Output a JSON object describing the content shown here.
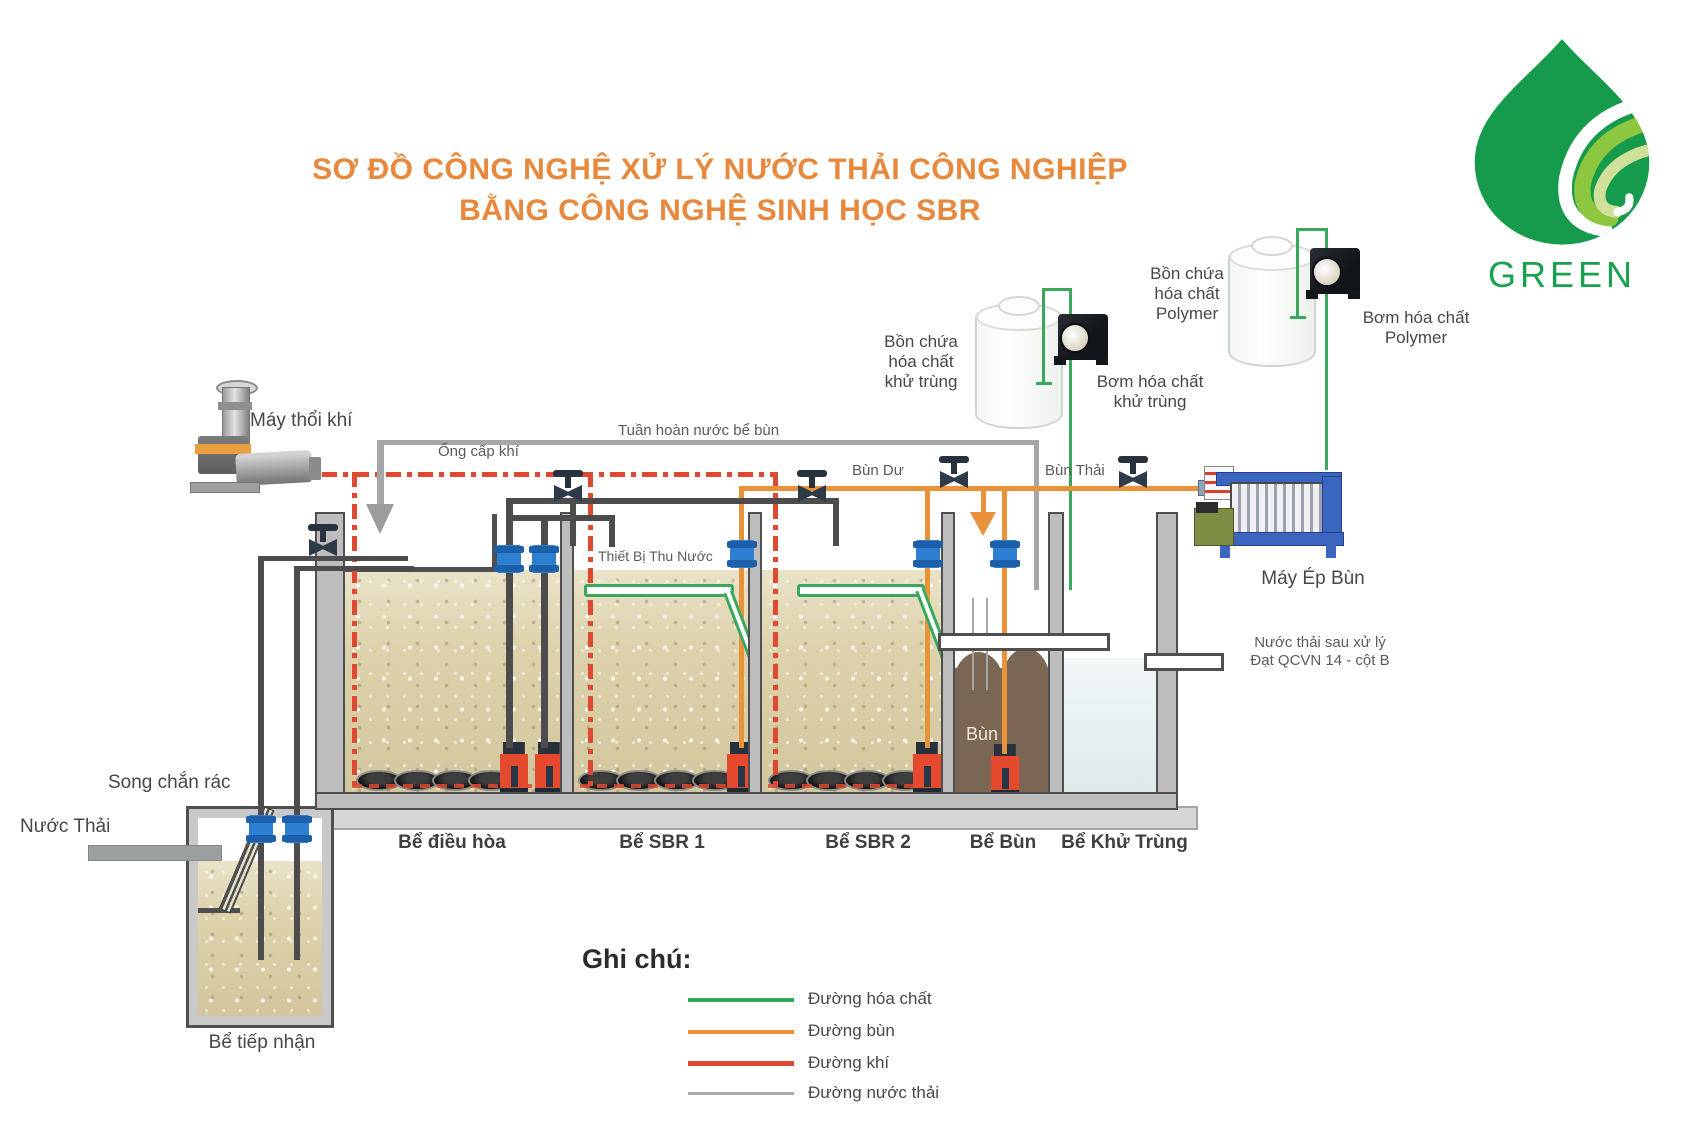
{
  "title": {
    "line1": "SƠ ĐỒ CÔNG NGHỆ XỬ LÝ NƯỚC THẢI CÔNG NGHIỆP",
    "line2": "BẰNG CÔNG NGHỆ SINH HỌC SBR"
  },
  "logo": {
    "text": "GREEN"
  },
  "colors": {
    "accent": "#e8883c",
    "chemical": "#3aa85c",
    "sludge": "#e8923a",
    "air": "#dd4a31",
    "waterline": "#a6a6a6"
  },
  "labels": {
    "blower": "Máy thổi khí",
    "air_supply": "Ống cấp khí",
    "recirculation": "Tuần hoàn nước bể bùn",
    "excess_sludge": "Bùn Dư",
    "waste_sludge": "Bùn Thải",
    "decanter": "Thiết Bị Thu Nước",
    "sludge": "Bùn",
    "chem_tank_disinfect": "Bồn chứa\nhóa chất\nkhử trùng",
    "chem_pump_disinfect": "Bơm hóa chất\nkhử trùng",
    "chem_tank_polymer": "Bồn chứa\nhóa chất\nPolymer",
    "chem_pump_polymer": "Bơm hóa chất\nPolymer",
    "sludge_press": "Máy Ép Bùn",
    "effluent": "Nước thải sau xử lý\nĐạt QCVN 14 - cột B",
    "bar_screen": "Song chắn rác",
    "influent": "Nước Thải",
    "reception_tank": "Bể tiếp nhận"
  },
  "tanks": [
    "Bể điều hòa",
    "Bể SBR 1",
    "Bể SBR 2",
    "Bể Bùn",
    "Bể Khử Trùng"
  ],
  "legend": {
    "title": "Ghi chú:",
    "items": [
      {
        "label": "Đường hóa chất",
        "color": "#3aa85c"
      },
      {
        "label": "Đường bùn",
        "color": "#e8923a"
      },
      {
        "label": "Đường khí",
        "color": "#dd4a31"
      },
      {
        "label": "Đường nước thải",
        "color": "#ababab"
      }
    ]
  }
}
